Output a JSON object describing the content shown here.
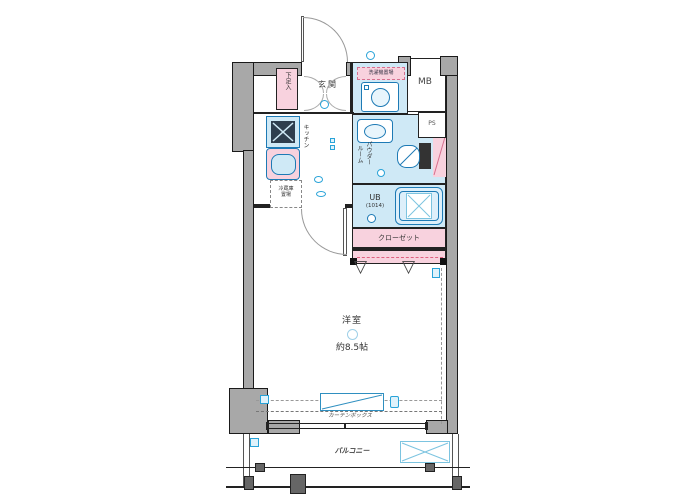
{
  "labels": {
    "entrance": "玄関",
    "shoe_box": "下足入",
    "washer_space": "洗濯機置場",
    "meter_box": "MB",
    "pipe_space": "PS",
    "kitchen": "キッチン",
    "fridge_line1": "冷蔵庫",
    "fridge_line2": "置場",
    "powder_line1": "パウダー",
    "powder_line2": "ルーム",
    "unit_bath": "UB",
    "unit_bath_size": "(1014)",
    "closet": "クローゼット",
    "room": "洋室",
    "room_size": "約8.5帖",
    "curtain_box": "カーテンボックス",
    "balcony": "バルコニー"
  },
  "icons": {
    "swing_triangle": "▽"
  },
  "colors": {
    "wall_gray": "#a8a8a8",
    "wet_area_blue": "#cfe9f6",
    "storage_pink": "#f8d2de",
    "fixture_blue": "#1d7ab5",
    "symbol_blue": "#29a3d8",
    "outline": "#1a1a1a"
  }
}
